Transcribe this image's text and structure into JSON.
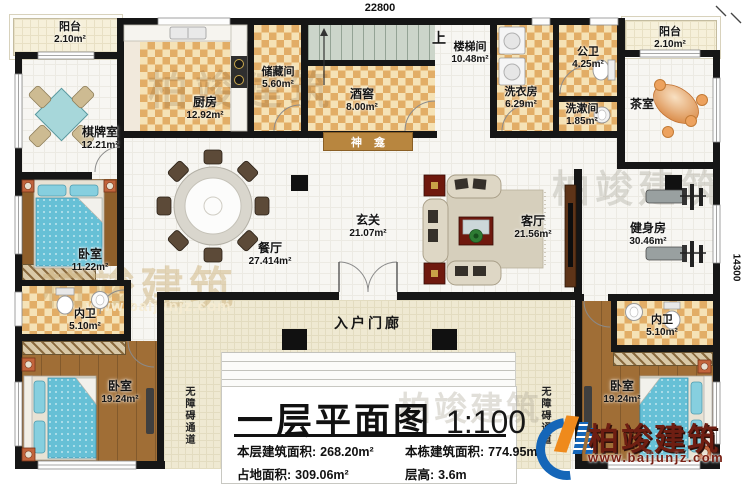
{
  "dims": {
    "top": "22800",
    "right": "14300"
  },
  "rooms": {
    "balcony_left": {
      "label": "阳台",
      "area": "2.10m²"
    },
    "kitchen": {
      "label": "厨房",
      "area": "12.92m²"
    },
    "storage": {
      "label": "储藏间",
      "area": "5.60m²"
    },
    "cellar": {
      "label": "酒窖",
      "area": "8.00m²"
    },
    "stair_up": {
      "label": "上"
    },
    "stairwell": {
      "label": "楼梯间",
      "area": "10.48m²"
    },
    "laundry": {
      "label": "洗衣房",
      "area": "6.29m²"
    },
    "public_bath": {
      "label": "公卫",
      "area": "4.25m²"
    },
    "washroom": {
      "label": "洗漱间",
      "area": "1.85m²"
    },
    "balcony_right": {
      "label": "阳台",
      "area": "2.10m²"
    },
    "tea_room": {
      "label": "茶室"
    },
    "chess_room": {
      "label": "棋牌室",
      "area": "12.21m²"
    },
    "bedroom_left": {
      "label": "卧室",
      "area": "11.22m²"
    },
    "bath_left": {
      "label": "内卫",
      "area": "5.10m²"
    },
    "bedroom_bl": {
      "label": "卧室",
      "area": "19.24m²"
    },
    "foyer": {
      "label": "玄关",
      "area": "21.07m²"
    },
    "dining": {
      "label": "餐厅",
      "area": "27.414m²"
    },
    "living": {
      "label": "客厅",
      "area": "21.56m²"
    },
    "gym": {
      "label": "健身房",
      "area": "30.46m²"
    },
    "bath_right": {
      "label": "内卫",
      "area": "5.10m²"
    },
    "bedroom_br": {
      "label": "卧室",
      "area": "19.24m²"
    },
    "shrine": {
      "label": "神龛"
    },
    "porch": {
      "label": "入户门廊"
    },
    "ramp": {
      "label": "无障碍通道"
    }
  },
  "title_block": {
    "title": "一层平面图",
    "scale": "1:100",
    "stats": [
      {
        "label": "本层建筑面积:",
        "value": "268.20m²"
      },
      {
        "label": "本栋建筑面积:",
        "value": "774.95m²"
      },
      {
        "label": "占地面积:",
        "value": "309.06m²"
      },
      {
        "label": "层高:",
        "value": "3.6m"
      }
    ]
  },
  "brand": {
    "name": "柏竣建筑",
    "url": "www.baijunjz.com"
  },
  "watermark": {
    "name": "柏竣建筑",
    "url": "www.baijunjz.com"
  },
  "colors": {
    "wall": "#161616",
    "checker": "#e2ad66",
    "wood": "#a06e36",
    "accent_blue": "#1566b8",
    "accent_orange": "#ef8a1c",
    "brand_red": "#6e1e12"
  }
}
